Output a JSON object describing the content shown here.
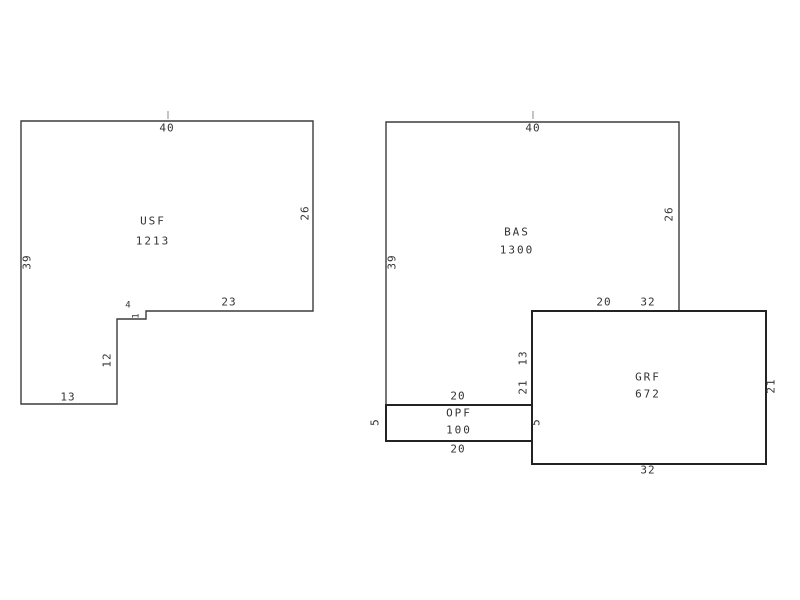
{
  "page": {
    "background": "#ffffff"
  },
  "sketch": {
    "stroke_color": "#3c3c3c",
    "thick_stroke_color": "#232323",
    "text_color": "#333333",
    "tick_color": "#c4c4c4",
    "shapes": [
      {
        "id": "usf",
        "name": "USF",
        "area_value": "1213",
        "points": "21,121 313,121 313,311 146,311 146,319 117,319 117,404 21,404",
        "thick": false,
        "name_x": 153,
        "name_y": 221,
        "value_x": 153,
        "value_y": 241
      },
      {
        "id": "bas",
        "name": "BAS",
        "area_value": "1300",
        "points": "386,122 679,122 679,311 532,311 532,405 386,405",
        "thick": false,
        "name_x": 517,
        "name_y": 232,
        "value_x": 517,
        "value_y": 250
      },
      {
        "id": "opf",
        "name": "OPF",
        "area_value": "100",
        "points": "386,405 532,405 532,441 386,441",
        "thick": true,
        "name_x": 459,
        "name_y": 413,
        "value_x": 459,
        "value_y": 430
      },
      {
        "id": "grf",
        "name": "GRF",
        "area_value": "672",
        "points": "532,311 766,311 766,464 532,464",
        "thick": true,
        "name_x": 648,
        "name_y": 377,
        "value_x": 648,
        "value_y": 394
      }
    ],
    "dim_labels": [
      {
        "text": "40",
        "x": 167,
        "y": 128,
        "rotated": false,
        "small": false
      },
      {
        "text": "26",
        "x": 305,
        "y": 213,
        "rotated": true,
        "small": false
      },
      {
        "text": "39",
        "x": 27,
        "y": 262,
        "rotated": true,
        "small": false
      },
      {
        "text": "23",
        "x": 229,
        "y": 302,
        "rotated": false,
        "small": false
      },
      {
        "text": "4",
        "x": 128,
        "y": 306,
        "rotated": false,
        "small": true
      },
      {
        "text": "1",
        "x": 137,
        "y": 316,
        "rotated": true,
        "small": true
      },
      {
        "text": "12",
        "x": 107,
        "y": 360,
        "rotated": true,
        "small": false
      },
      {
        "text": "13",
        "x": 68,
        "y": 397,
        "rotated": false,
        "small": false
      },
      {
        "text": "40",
        "x": 533,
        "y": 128,
        "rotated": false,
        "small": false
      },
      {
        "text": "26",
        "x": 669,
        "y": 214,
        "rotated": true,
        "small": false
      },
      {
        "text": "39",
        "x": 392,
        "y": 262,
        "rotated": true,
        "small": false
      },
      {
        "text": "20",
        "x": 604,
        "y": 302,
        "rotated": false,
        "small": false
      },
      {
        "text": "32",
        "x": 648,
        "y": 302,
        "rotated": false,
        "small": false
      },
      {
        "text": "13",
        "x": 523,
        "y": 358,
        "rotated": true,
        "small": false
      },
      {
        "text": "21",
        "x": 523,
        "y": 387,
        "rotated": true,
        "small": false
      },
      {
        "text": "20",
        "x": 458,
        "y": 396,
        "rotated": false,
        "small": false
      },
      {
        "text": "5",
        "x": 375,
        "y": 422,
        "rotated": true,
        "small": false
      },
      {
        "text": "5",
        "x": 536,
        "y": 422,
        "rotated": true,
        "small": false
      },
      {
        "text": "20",
        "x": 458,
        "y": 449,
        "rotated": false,
        "small": false
      },
      {
        "text": "21",
        "x": 771,
        "y": 386,
        "rotated": true,
        "small": false
      },
      {
        "text": "32",
        "x": 648,
        "y": 470,
        "rotated": false,
        "small": false
      }
    ],
    "ticks": [
      {
        "x": 168,
        "y1": 111,
        "y2": 119
      },
      {
        "x": 533,
        "y1": 111,
        "y2": 119
      }
    ]
  }
}
